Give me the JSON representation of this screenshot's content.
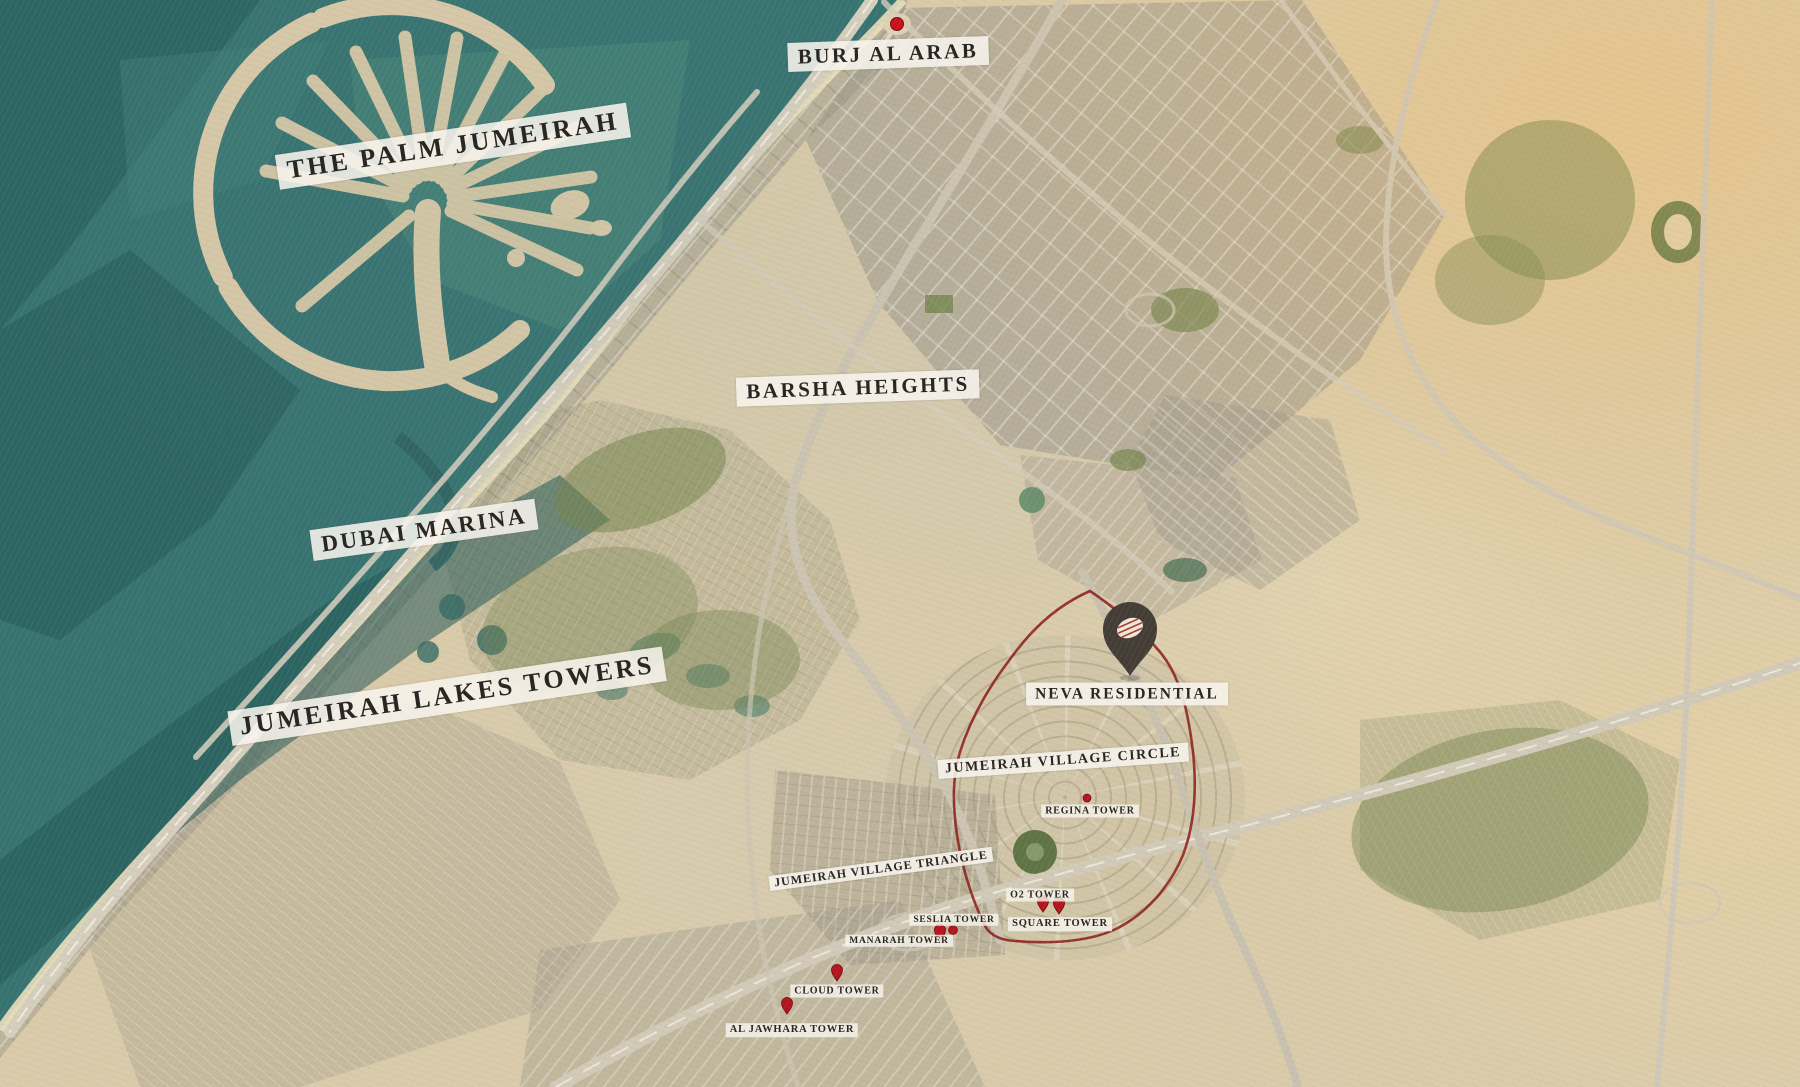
{
  "map": {
    "labels": {
      "palm": "THE PALM JUMEIRAH",
      "burj": "BURJ AL ARAB",
      "barsha": "BARSHA HEIGHTS",
      "marina": "DUBAI MARINA",
      "jlt": "JUMEIRAH LAKES TOWERS",
      "neva": "NEVA RESIDENTIAL",
      "jvc": "JUMEIRAH VILLAGE CIRCLE",
      "jvt": "JUMEIRAH VILLAGE TRIANGLE",
      "regina": "REGINA TOWER",
      "o2": "O2 TOWER",
      "square": "SQUARE TOWER",
      "seslia": "SESLIA TOWER",
      "manarah": "MANARAH TOWER",
      "cloud": "CLOUD TOWER",
      "jawhara": "AL JAWHARA TOWER"
    },
    "icons": {
      "neva_pin": "dark-map-pin",
      "burj_marker": "red-dot-marker",
      "tower_marker": "red-pin-marker",
      "boundary": "red-community-outline"
    },
    "colors": {
      "boundary_red": "#8e2420",
      "marker_red": "#b5151c",
      "pin_charcoal": "#433d36",
      "sea_teal": "#377371",
      "sand": "#d9cbaa",
      "label_bg": "#f7f4ed",
      "label_text": "#2a2623"
    }
  }
}
